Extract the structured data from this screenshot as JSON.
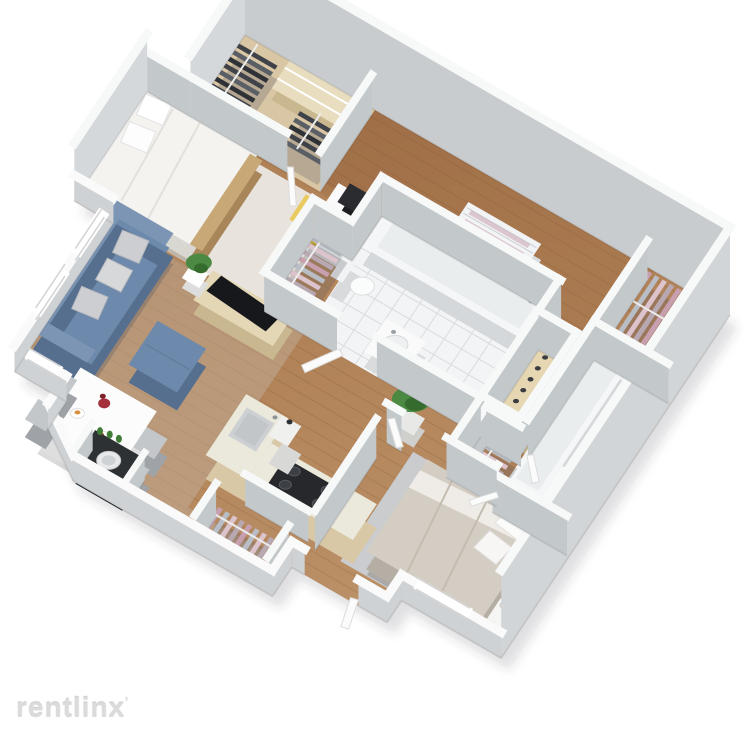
{
  "watermark": {
    "text": "rentlinx",
    "mark": "'"
  },
  "palette": {
    "bg": "#ffffff",
    "wallTop": "#f7f8f8",
    "wallTopLow": "#fafafa",
    "wallFaceN": "#c8ccce",
    "wallFaceE": "#d2d5d7",
    "wallFaceInt": "#c3c8cb",
    "wallFaceLow": "#cfd2d4",
    "wallFaceWest": "#d5d8da",
    "woodBase": "#b08055",
    "woodDark": "#96653e",
    "woodLivingTint": "#c3b4a2",
    "woodBedroomTint": "#c79a6d",
    "plankLine": "rgba(90,50,20,0.14)",
    "tanCloset": "#d8c6a4",
    "tile": "#f2f4f5",
    "tileLine": "#d9dcde",
    "rugWhite": "#edecE8",
    "rugMaster": "#ccd3da",
    "sofaBlue": "#6d89ab",
    "sofaBlueDark": "#566f8e",
    "sofaBlueLight": "#7c95b4",
    "cushionGray": "#ccced2",
    "furnWood": "#e4d7b6",
    "furnWoodDark": "#c8b78f",
    "tvBlack": "#17181b",
    "chairYellow": "#e9ca60",
    "chairYellowDark": "#c9a83e",
    "clothesPinkA": "#c89fae",
    "clothesPinkB": "#b9bec6",
    "clothesPinkC": "#dcc3cc",
    "clothesDarkA": "#3f4248",
    "clothesDarkB": "#5a5e65",
    "plantGreen": "#4c8a44",
    "plantGreenDark": "#356c2e",
    "counterTop": "#ebe8dc",
    "cabinet": "#d8c8a6",
    "steel": "#ccd0d3",
    "applianceDark": "#26282b",
    "fixtureWhite": "#fafbfb",
    "fixtureSide": "#dcdedf",
    "grayChair": "#c4c7ca",
    "grayChairDark": "#9fa3a7",
    "bedBeige": "#d4cdc3",
    "bedBeigeDark": "#b5aea4",
    "flowerRed": "#a3303a",
    "shadow": "rgba(70,70,82,0.16)"
  },
  "rooms": [
    {
      "name": "walk-in-closet",
      "items": [
        "shelf-boxes",
        "dark-clothes-rack"
      ]
    },
    {
      "name": "hallway-north",
      "items": [
        "linen-shelf"
      ]
    },
    {
      "name": "bedroom-1",
      "items": [
        "bed",
        "pillows",
        "nightstand",
        "potted-plant",
        "area-rug",
        "desk",
        "monitor",
        "yellow-chair",
        "closet-pink-clothes"
      ]
    },
    {
      "name": "bathroom-1",
      "items": [
        "bathtub",
        "toilet",
        "sink-cabinet",
        "tile-floor"
      ]
    },
    {
      "name": "closet-east",
      "items": [
        "pink-clothes-rack"
      ]
    },
    {
      "name": "master-walk-in",
      "items": [
        "shoe-shelf",
        "pink-clothes-rack"
      ]
    },
    {
      "name": "bathroom-2",
      "items": [
        "bathtub",
        "toilet",
        "vanity-sink",
        "tile-floor",
        "pink-clothes-closet"
      ]
    },
    {
      "name": "master-bedroom",
      "items": [
        "bed",
        "pillows",
        "nightstands",
        "area-rug",
        "window"
      ]
    },
    {
      "name": "living-room",
      "items": [
        "blue-sofa",
        "gray-cushions",
        "blue-ottoman",
        "tv-console",
        "tv",
        "potted-plant",
        "windows"
      ]
    },
    {
      "name": "dining-area",
      "items": [
        "white-table",
        "gray-chairs",
        "red-flowers",
        "plates"
      ]
    },
    {
      "name": "kitchen",
      "items": [
        "l-counter",
        "sink",
        "gas-cooktop",
        "large-plant"
      ]
    },
    {
      "name": "laundry-nook",
      "items": [
        "washing-machine",
        "green-bottles"
      ]
    },
    {
      "name": "entry",
      "items": [
        "open-door",
        "coat-closet-pink-clothes"
      ]
    }
  ]
}
